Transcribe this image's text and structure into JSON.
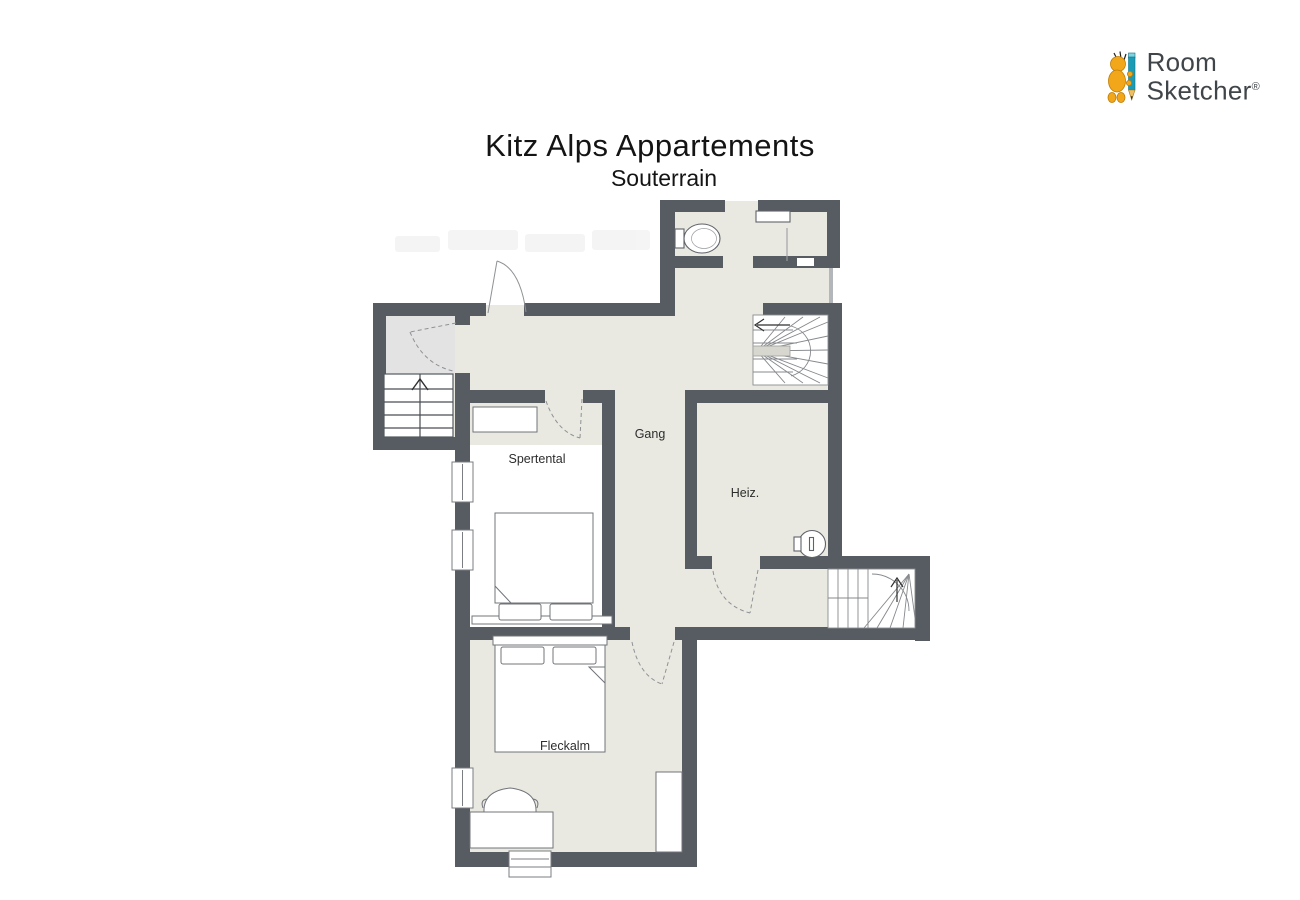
{
  "header": {
    "title": "Kitz Alps Appartements",
    "subtitle": "Souterrain"
  },
  "logo": {
    "word1": "Room",
    "word2": "Sketcher",
    "registered": "®",
    "brand_yellow": "#f2a71b",
    "brand_teal": "#1b9cb4",
    "text_color": "#40454a"
  },
  "floorplan": {
    "rooms": [
      {
        "id": "gang",
        "label": "Gang"
      },
      {
        "id": "spertental",
        "label": "Spertental"
      },
      {
        "id": "heiz",
        "label": "Heiz."
      },
      {
        "id": "fleckalm",
        "label": "Fleckalm"
      }
    ],
    "colors": {
      "wall": "#575b62",
      "floor": "#e9e9e1",
      "entry_floor": "#e3e3e4",
      "furniture_fill": "#ffffff",
      "furniture_outline": "#70747a",
      "door_arc": "#8f9295",
      "label_color": "#2d2d2d"
    },
    "symbols": [
      "toilet",
      "shelf",
      "shower-screen",
      "boiler",
      "double-bed",
      "pillow",
      "closet",
      "wardrobe",
      "desk",
      "armchair",
      "window",
      "straight-staircase-up",
      "winder-staircase",
      "lower-winder-staircase"
    ]
  }
}
